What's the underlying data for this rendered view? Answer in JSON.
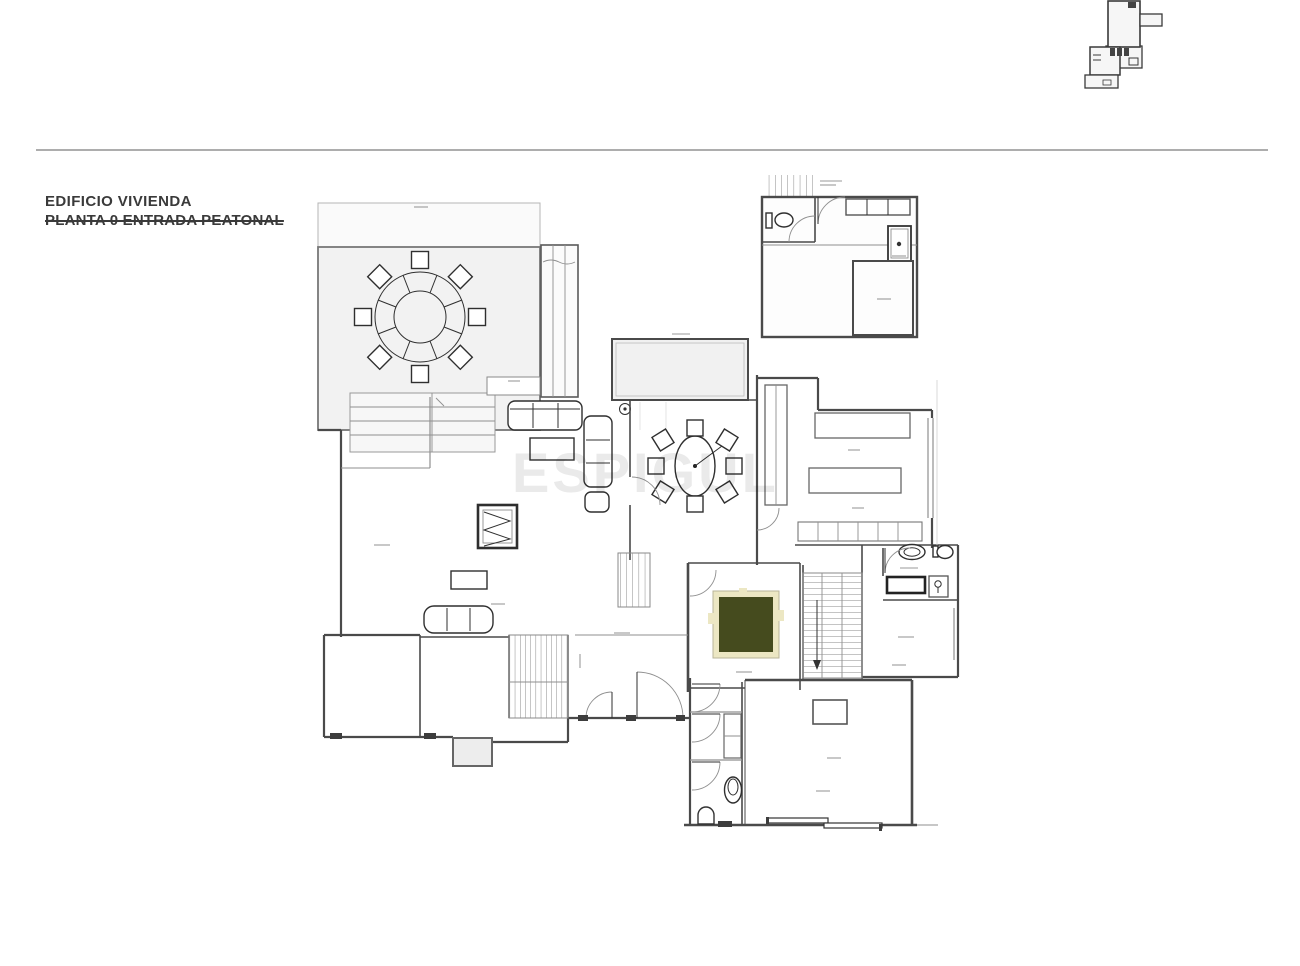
{
  "title_block": {
    "line1": "EDIFICIO VIVIENDA",
    "line2": "PLANTA 0 ENTRADA PEATONAL",
    "line2_struck_through": true
  },
  "watermark": {
    "text": "ESPIGUL"
  },
  "key_plan": {
    "description": "miniature building location plan, top-right corner"
  },
  "plan": {
    "type": "architectural floor plan, ground floor pedestrian entrance",
    "symbols": [
      "terrace-round-table-with-8-chairs",
      "dining-oval-table-with-8-chairs",
      "living-room-sofas-and-coffee-table",
      "elevator-shaft",
      "main-staircase",
      "secondary-stairs",
      "exterior-steps",
      "entry-ramp-hatching",
      "kitchen-counters-and-island",
      "kitchen-base-cabinets",
      "bathroom-sink-and-toilet",
      "shower-cabinet",
      "plant-pot",
      "wc-toilet-and-urinal",
      "garden-planter-courtyard",
      "skylight-opening",
      "sliding-window-panels",
      "garage-entry-block-with-wc-and-closets",
      "water-heater-appliance"
    ],
    "terrace_table_chairs": 8,
    "dining_table_chairs": 8
  },
  "colors": {
    "ink": "#3d3d3d",
    "wall": "#4a4a4a",
    "thin_line": "#8f8f8f",
    "furniture": "#2f2f2f",
    "terrace_fill": "#f2f2f2",
    "patio_fill": "#f1f1f1",
    "room_fill": "#fdfdfd",
    "planter_green": "#454b1e",
    "planter_cream": "#ece7c3",
    "divider": "#adadad",
    "watermark": "#c6c6c6",
    "title": "#3a3a3a"
  }
}
